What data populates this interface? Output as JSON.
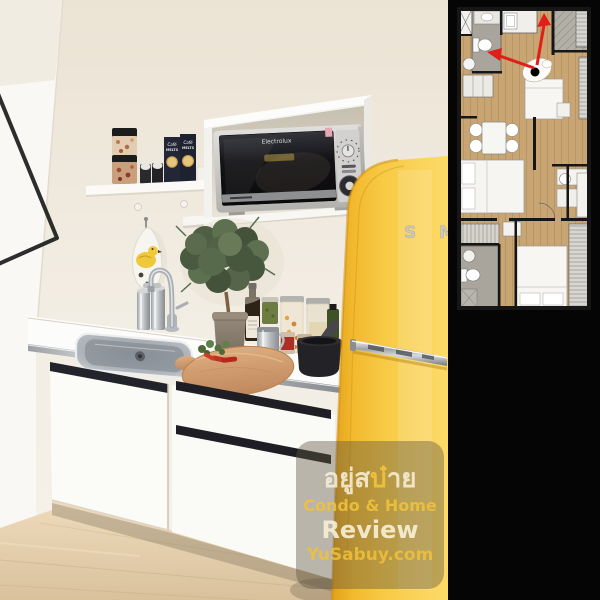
{
  "photo": {
    "microwave_brand": "Electrolux",
    "coffee_box_line1": "Café",
    "coffee_box_line2": "MELTS",
    "fridge_letter_s": "S",
    "fridge_letter_m": "M"
  },
  "watermark": {
    "thai_pre": "อยู่ส",
    "thai_accent": "บ๋",
    "thai_post": "าย",
    "line2": "Condo & Home",
    "line3": "Review",
    "line4": "YuSabuy.com",
    "cream_color": "#f6eed6",
    "yellow_color": "#efc13b"
  },
  "floorplan": {
    "arrow_color": "#e01f18",
    "wood_color": "#c9a574",
    "tile_color": "#a9a59c",
    "paper_color": "#e8e5df",
    "wall_color": "#161616"
  },
  "palette": {
    "panel_black": "#050505",
    "fridge_yellow": "#f6c33c",
    "wall_cream": "#f2eee5",
    "floor_wood": "#e3cfab",
    "cabinet_white": "#fbfbf8"
  }
}
